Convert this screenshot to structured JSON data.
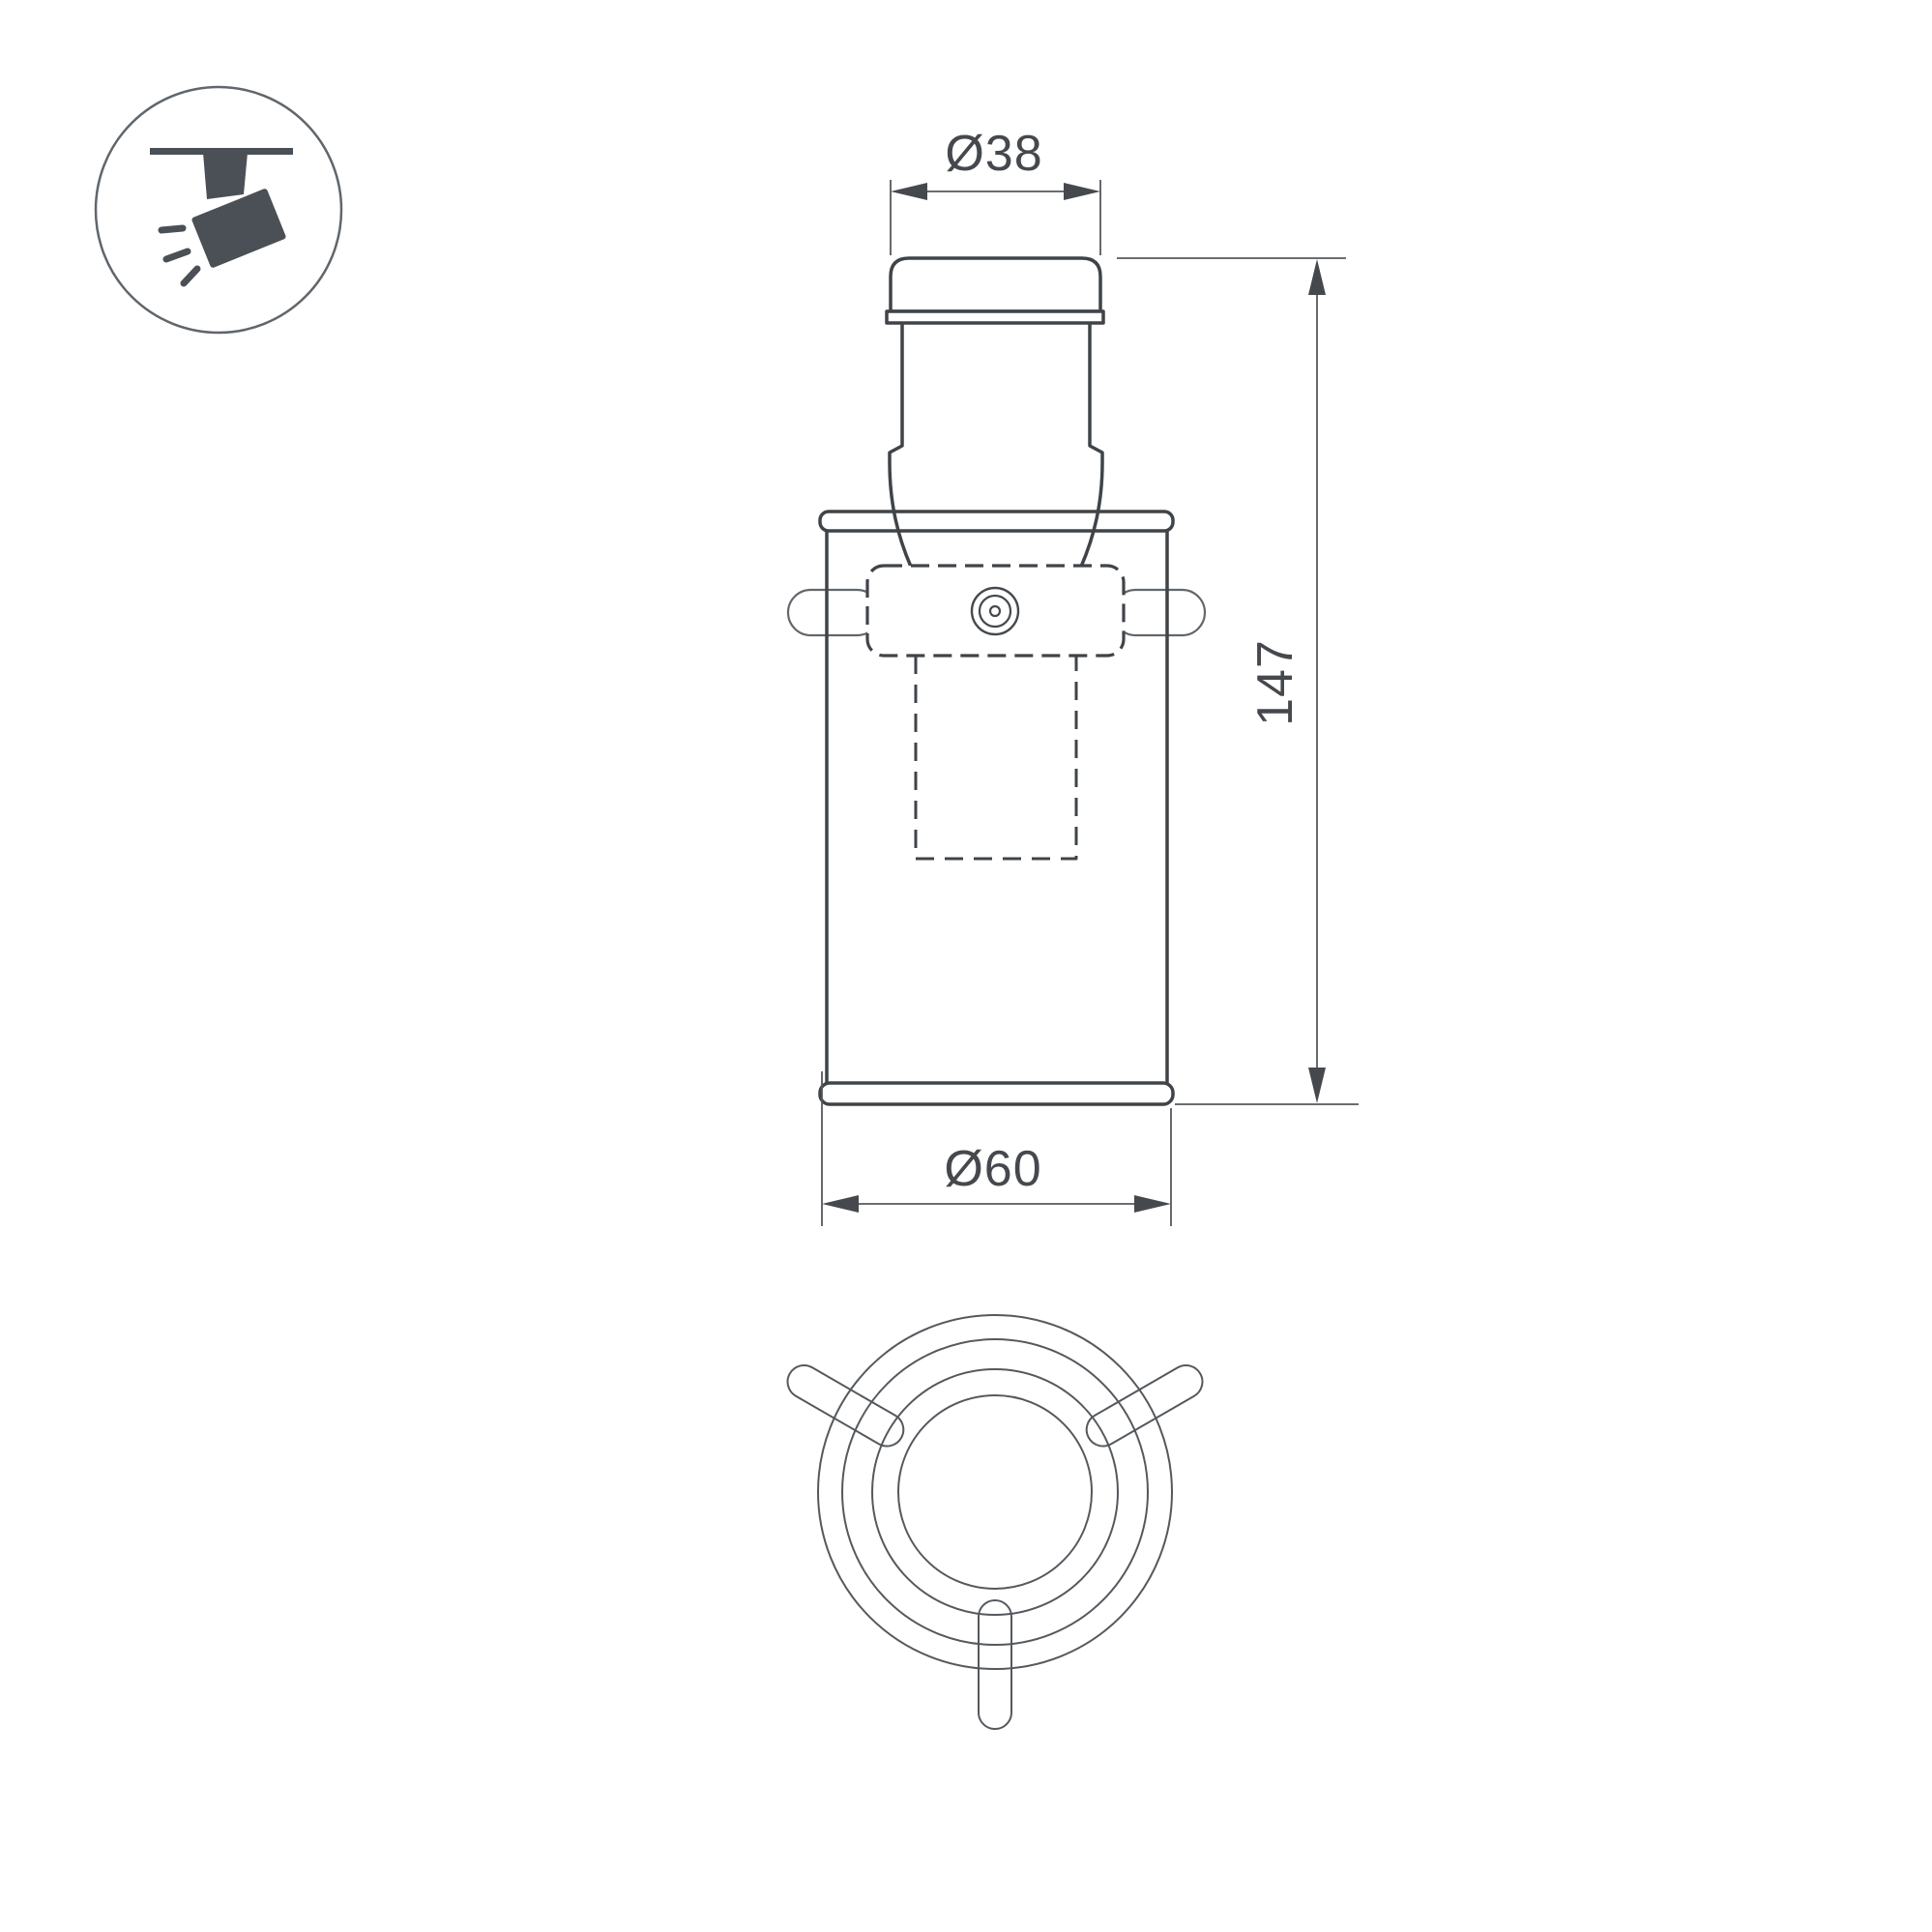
{
  "page": {
    "background": "#ffffff",
    "type": "technical-dimension-drawing"
  },
  "icon": {
    "name": "track-spotlight-pictogram",
    "glyph_color": "#4a5055",
    "ring_color": "#60666b"
  },
  "drawing": {
    "outline_color": "#3f4449",
    "pin_color": "#62676c",
    "dim_line_color": "#55595e",
    "dim_text_color": "#45494e",
    "dims": {
      "top_diameter": "Ø38",
      "height": "147",
      "bottom_diameter": "Ø60"
    }
  }
}
